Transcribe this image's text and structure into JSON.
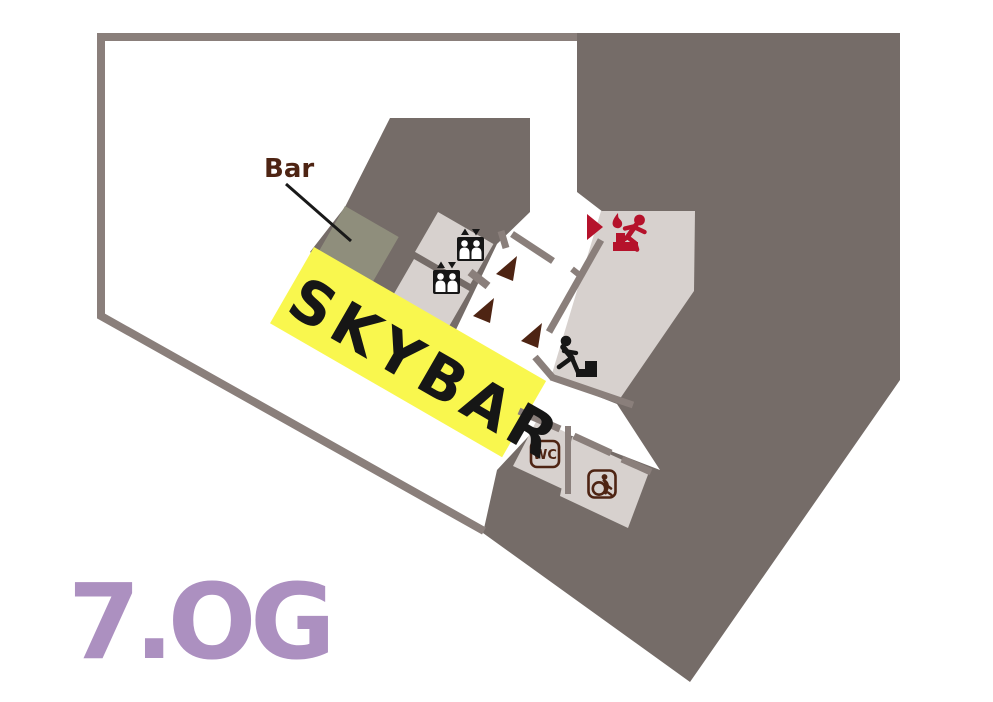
{
  "plan": {
    "floor_label": "7.OG",
    "venue_label": "SKYBAR",
    "bar_label": "Bar",
    "wc_label": "WC",
    "colors": {
      "wall": "#8a7f7b",
      "footprint": "#756c68",
      "room_light": "#d7d1ce",
      "bar_counter": "#8f8e7c",
      "highlight_yellow": "#f9f74e",
      "floor_label_purple": "#ac90c0",
      "brown": "#4e2413",
      "exit_red": "#b5122b",
      "icon_black": "#161616"
    },
    "icons": {
      "elevators": "elevator-icon",
      "stairs": "stairs-icon",
      "emergency_exit": "emergency-exit-icon",
      "accessible_wc": "accessible-wc-icon",
      "door_markers": "door-direction-triangle",
      "exit_marker": "exit-direction-triangle"
    }
  }
}
